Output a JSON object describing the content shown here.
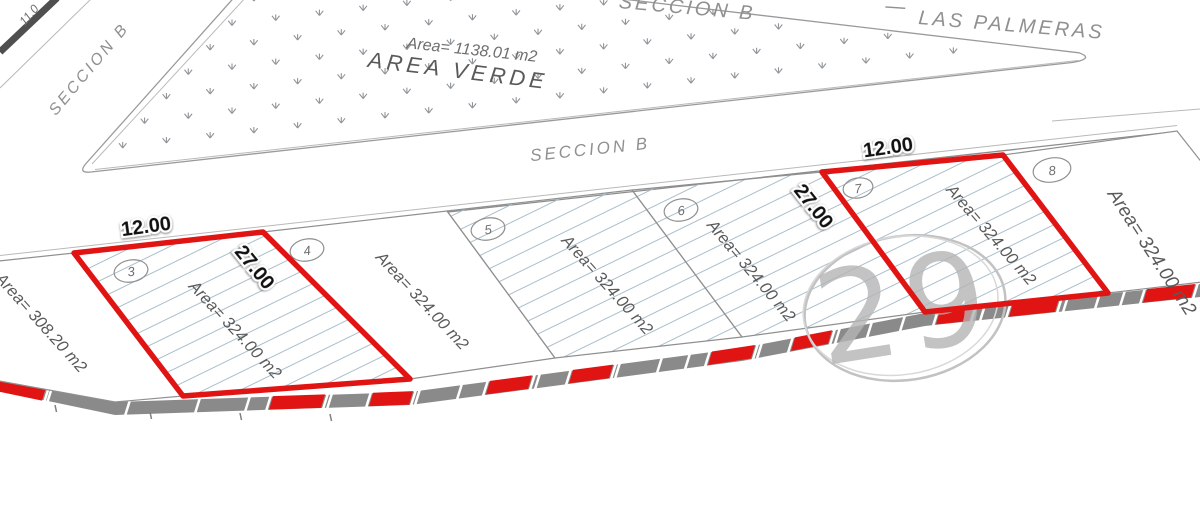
{
  "streets": {
    "seccion_b": "SECCION B",
    "las_palmeras": "LAS PALMERAS",
    "dash": "—"
  },
  "green_area": {
    "name": "AREA VERDE",
    "area": "Area= 1138.01 m2"
  },
  "dimensions": {
    "top_left": "11.0"
  },
  "lots": [
    {
      "number": "",
      "area": "Area= 308.20 m2",
      "highlighted": false
    },
    {
      "number": "3",
      "area": "Area= 324.00 m2",
      "highlighted": true,
      "front": "12.00",
      "depth": "27.00"
    },
    {
      "number": "4",
      "area": "Area= 324.00 m2",
      "highlighted": false
    },
    {
      "number": "5",
      "area": "Area= 324.00 m2",
      "highlighted": false
    },
    {
      "number": "6",
      "area": "Area= 324.00 m2",
      "highlighted": false
    },
    {
      "number": "7",
      "area": "Area= 324.00 m2",
      "highlighted": true,
      "front": "12.00",
      "depth": "27.00"
    },
    {
      "number": "8",
      "area": "Area= 324.00 m2",
      "highlighted": false
    }
  ],
  "watermark": "29",
  "colors": {
    "highlight": "#e11414",
    "road_strip": "#8a8a8a",
    "hatch": "#aabfca",
    "line_gray": "#8c8c8c",
    "text_gray": "#5a5a5a"
  }
}
